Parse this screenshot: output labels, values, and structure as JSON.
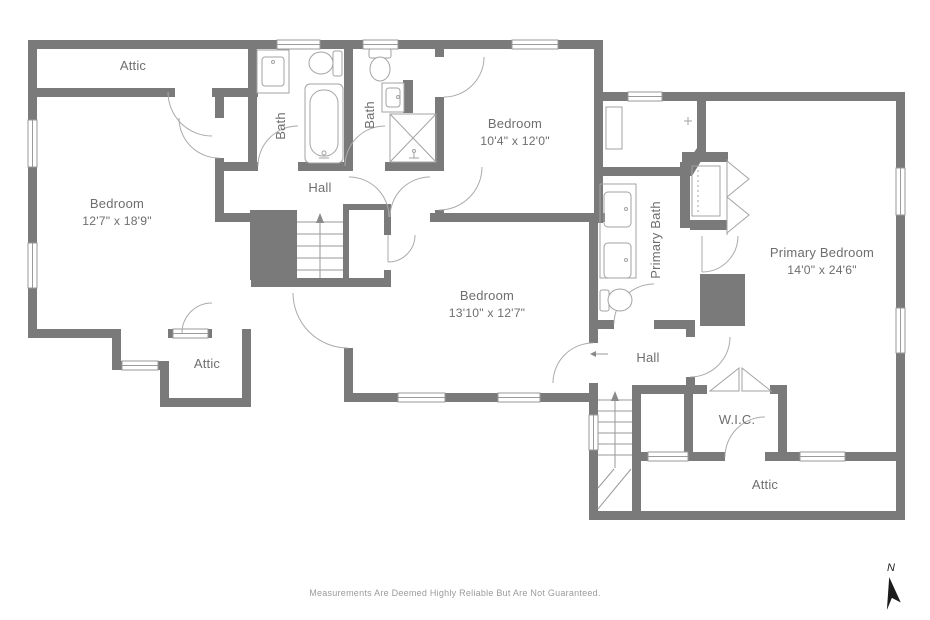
{
  "colors": {
    "wall": "#7a7a7a",
    "line": "#9a9a9a",
    "door": "#ababab",
    "fixture": "#a3a3a3",
    "text": "#6e6e6e",
    "muted": "#9b9b9b",
    "compass": "#1c1c1c"
  },
  "rooms": {
    "attic_top": {
      "label": "Attic"
    },
    "bedroom_left": {
      "label": "Bedroom",
      "dims": "12'7\" x 18'9\""
    },
    "bath_1": {
      "label": "Bath"
    },
    "bath_2": {
      "label": "Bath"
    },
    "bedroom_top": {
      "label": "Bedroom",
      "dims": "10'4\" x 12'0\""
    },
    "hall_1": {
      "label": "Hall"
    },
    "primary_bath": {
      "label": "Primary Bath"
    },
    "bedroom_center": {
      "label": "Bedroom",
      "dims": "13'10\" x 12'7\""
    },
    "primary_bedroom": {
      "label": "Primary Bedroom",
      "dims": "14'0\" x 24'6\""
    },
    "attic_left": {
      "label": "Attic"
    },
    "hall_2": {
      "label": "Hall"
    },
    "wic": {
      "label": "W.I.C."
    },
    "attic_bottom": {
      "label": "Attic"
    }
  },
  "footer": {
    "disclaimer": "Measurements Are Deemed Highly Reliable But Are Not Guaranteed."
  },
  "compass": {
    "label": "N"
  }
}
